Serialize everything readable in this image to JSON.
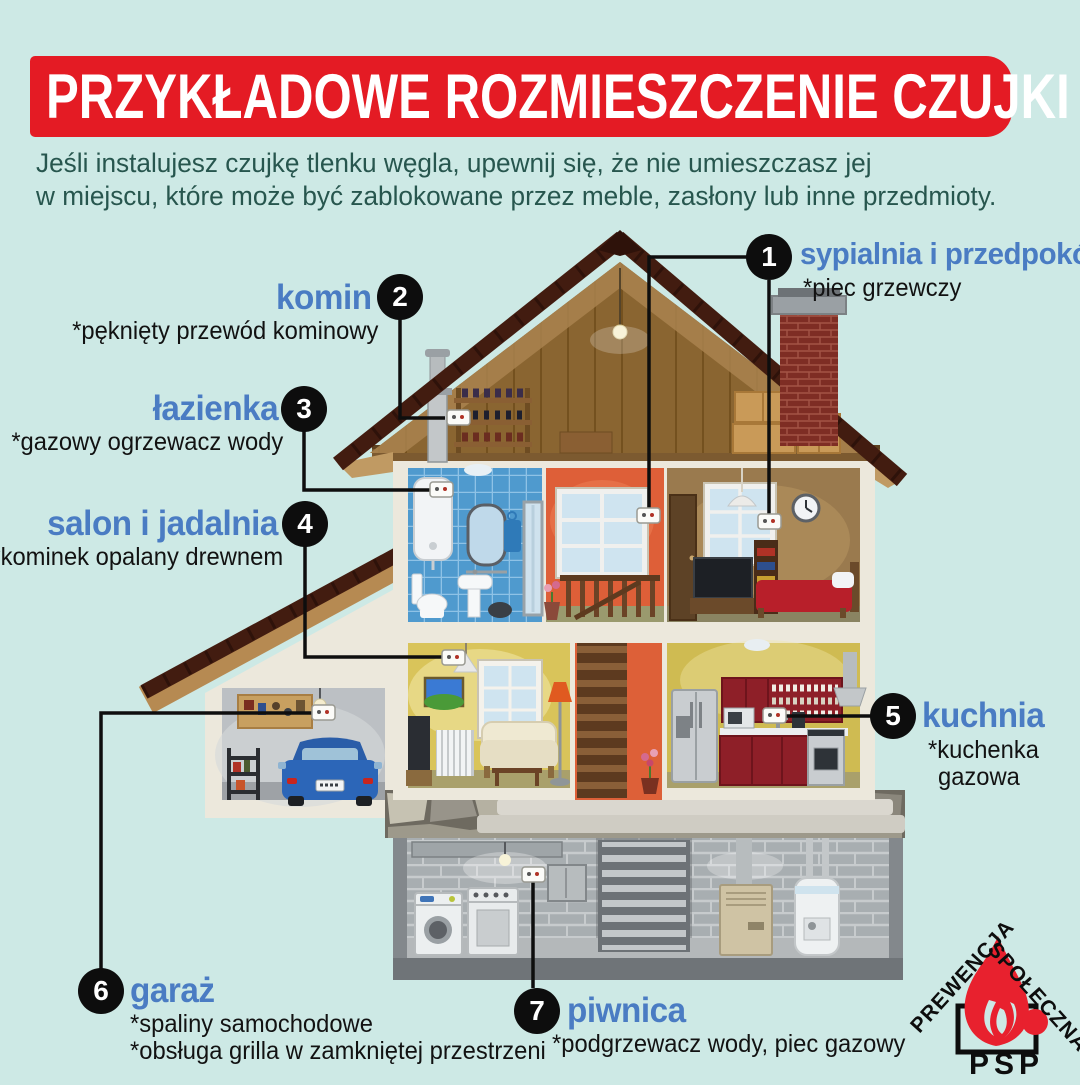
{
  "header": {
    "title": "PRZYKŁADOWE ROZMIESZCZENIE CZUJKI"
  },
  "intro": {
    "line1": "Jeśli instalujesz czujkę tlenku węgla, upewnij się, że nie umieszczasz jej",
    "line2": "w miejscu, które może być zablokowane przez meble, zasłony lub inne przedmioty."
  },
  "callouts": [
    {
      "number": "1",
      "name": "sypialnia i przedpokój",
      "details": [
        "*piec grzewczy"
      ]
    },
    {
      "number": "2",
      "name": "komin",
      "details": [
        "*pęknięty przewód kominowy"
      ]
    },
    {
      "number": "3",
      "name": "łazienka",
      "details": [
        "*gazowy ogrzewacz wody"
      ]
    },
    {
      "number": "4",
      "name": "salon i jadalnia",
      "details": [
        "*kominek opalany drewnem"
      ]
    },
    {
      "number": "5",
      "name": "kuchnia",
      "details": [
        "*kuchenka",
        "gazowa"
      ]
    },
    {
      "number": "6",
      "name": "garaż",
      "details": [
        "*spaliny samochodowe",
        "*obsługa grilla w zamkniętej przestrzeni"
      ]
    },
    {
      "number": "7",
      "name": "piwnica",
      "details": [
        "*podgrzewacz wody, piec gazowy"
      ]
    }
  ],
  "logo": {
    "arc_left": "PREWENCJA",
    "arc_right": "SPOŁECZNA",
    "acronym": "PSP"
  },
  "colors": {
    "background": "#cde9e5",
    "banner_red": "#e41b24",
    "label_blue": "#4a7cc3",
    "intro_teal": "#27564e",
    "logo_red": "#e8212e",
    "line_black": "#0d0d0d"
  }
}
